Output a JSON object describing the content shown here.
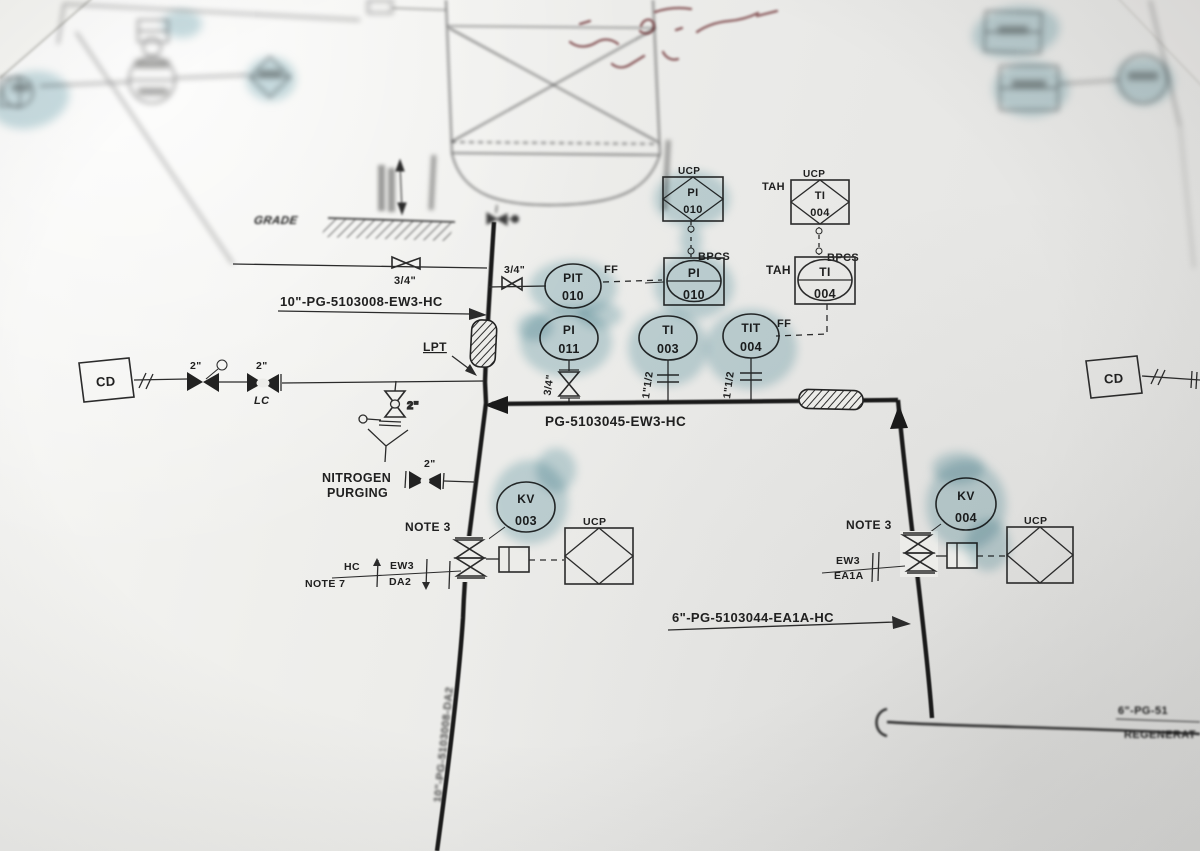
{
  "colors": {
    "ink": "#2b2b2b",
    "pipe": "#1a1a1a",
    "highlighter": "#79adb9",
    "handwriting_red": "#6e3134",
    "paper": "#ecece9"
  },
  "pipe_labels": {
    "header_line": "10\"-PG-5103008-EW3-HC",
    "main_line": "PG-5103045-EW3-HC",
    "branch_line": "6\"-PG-5103044-EA1A-HC",
    "vertical_line": "10\"-PG-5103008-DA2",
    "edge_line_top": "6\"-PG-51",
    "edge_line_bottom": "REGENERAT"
  },
  "annotations": {
    "grade": "GRADE",
    "lpt": "LPT",
    "nitrogen_line1": "NITROGEN",
    "nitrogen_line2": "PURGING",
    "note_3": "NOTE 3",
    "note_7": "NOTE 7",
    "lc": "LC",
    "ff": "FF",
    "bpcs": "BPCS",
    "tah": "TAH",
    "ucp": "UCP",
    "cd": "CD"
  },
  "line_sizes": {
    "three_quarter_inch": "3/4\"",
    "two_inch": "2\"",
    "one_and_half_inch": "1\"1/2"
  },
  "spec_breaks": {
    "hc": "HC",
    "ew3": "EW3",
    "da2": "DA2",
    "ea1a": "EA1A"
  },
  "instruments": {
    "pit010": {
      "tag": "PIT",
      "num": "010"
    },
    "pi010_panel": {
      "tag": "PI",
      "num": "010"
    },
    "pi010_ucp": {
      "tag": "PI",
      "num": "010"
    },
    "ti004_ucp": {
      "tag": "TI",
      "num": "004"
    },
    "ti004_panel": {
      "tag": "TI",
      "num": "004"
    },
    "pi011": {
      "tag": "PI",
      "num": "011"
    },
    "ti003": {
      "tag": "TI",
      "num": "003"
    },
    "tit004": {
      "tag": "TIT",
      "num": "004"
    },
    "kv003": {
      "tag": "KV",
      "num": "003"
    },
    "kv004": {
      "tag": "KV",
      "num": "004"
    }
  }
}
